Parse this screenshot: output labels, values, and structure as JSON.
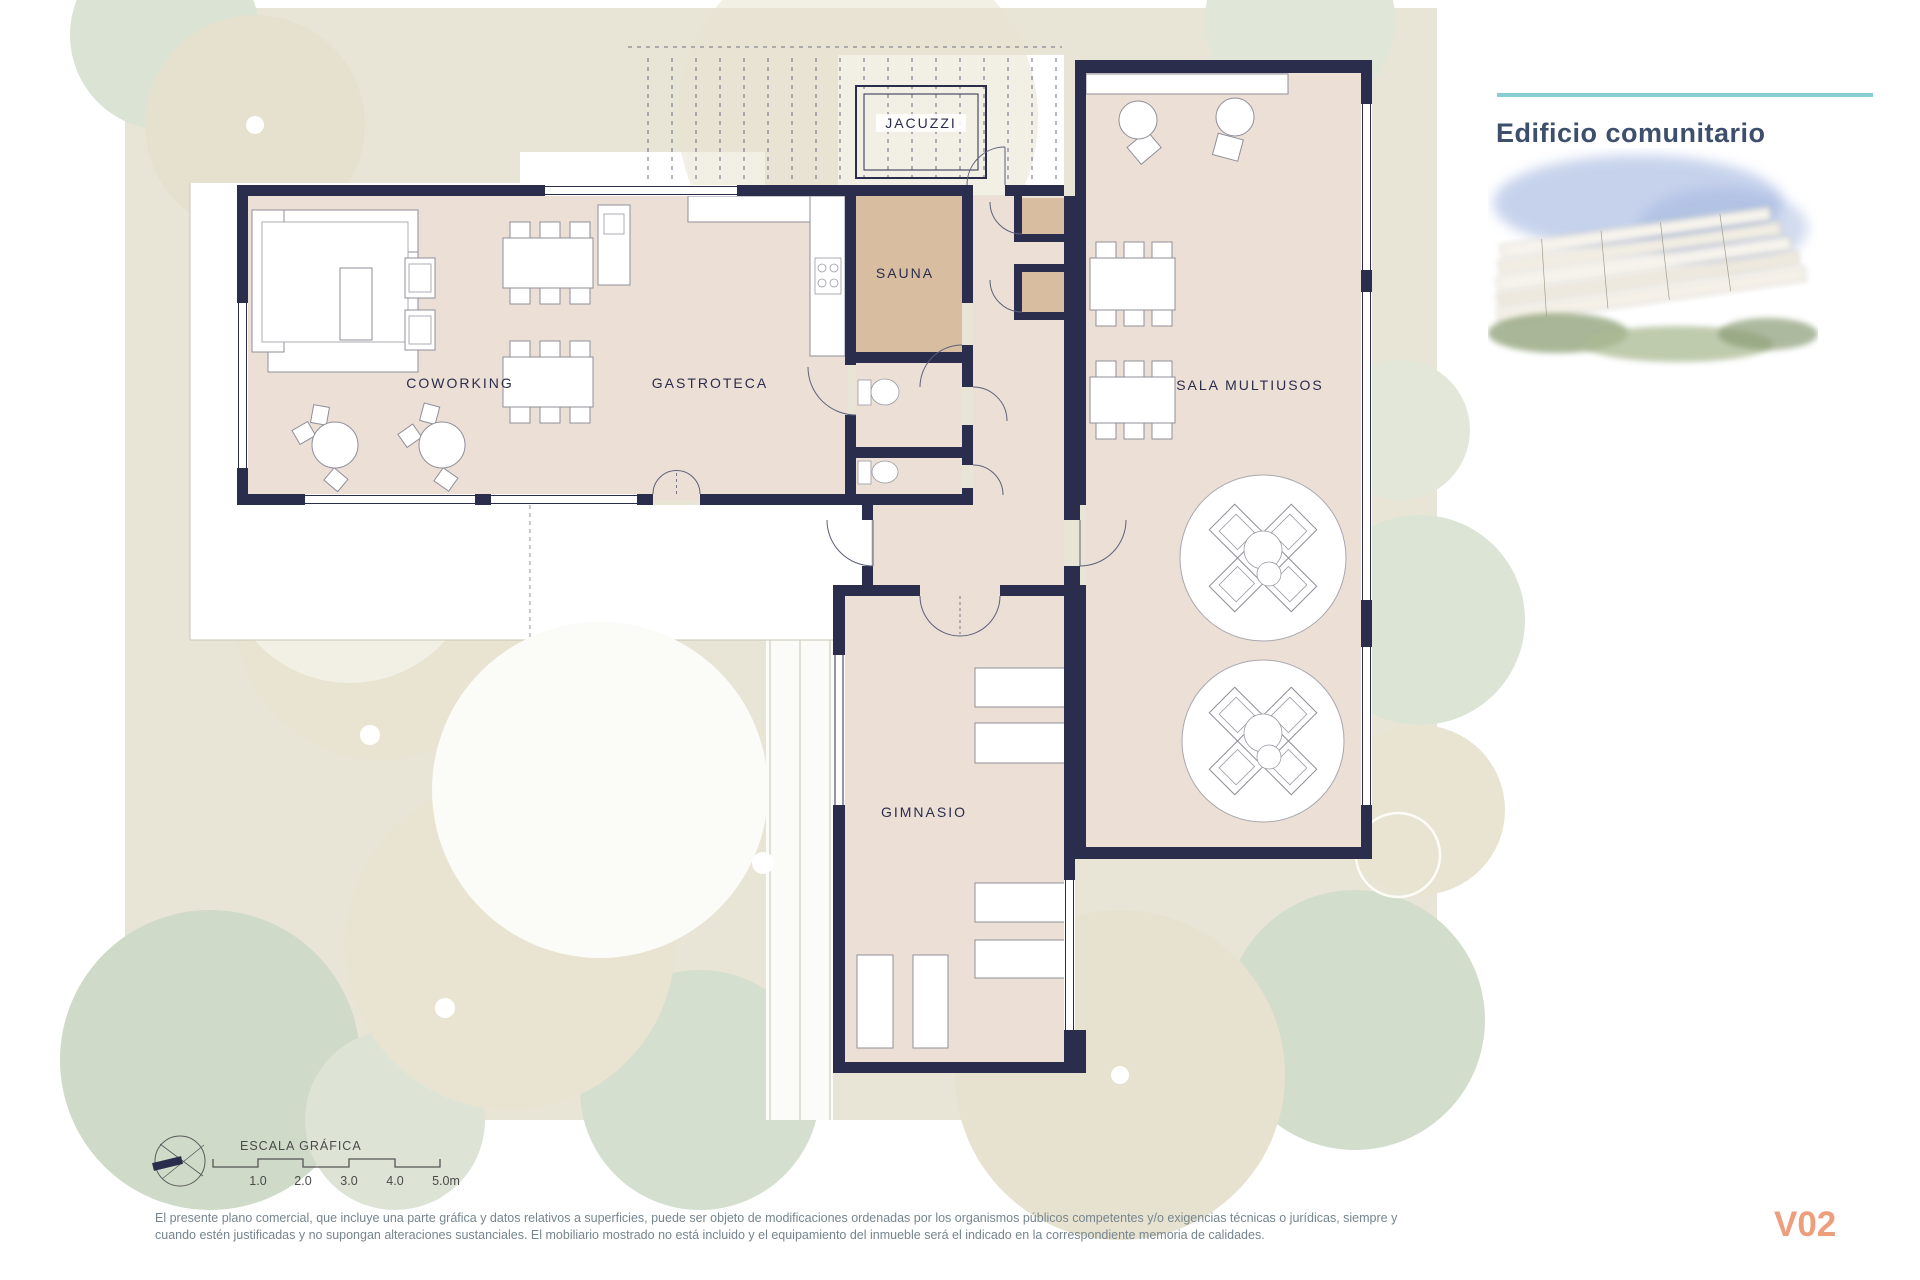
{
  "panel": {
    "title": "Edificio comunitario"
  },
  "version_label": "V02",
  "rooms": {
    "jacuzzi": "JACUZZI",
    "sauna": "SAUNA",
    "coworking": "COWORKING",
    "gastroteca": "GASTROTECA",
    "sala_multiusos": "SALA MULTIUSOS",
    "gimnasio": "GIMNASIO"
  },
  "scale_bar": {
    "title": "ESCALA GRÁFICA",
    "ticks": [
      "1.0",
      "2.0",
      "3.0",
      "4.0",
      "5.0m"
    ]
  },
  "disclaimer": {
    "line1": "El presente plano comercial, que incluye una parte gráfica y datos relativos a superficies, puede ser objeto de modificaciones ordenadas por los organismos públicos competentes y/o exigencias técnicas o jurídicas, siempre y",
    "line2": "cuando estén justificadas y no supongan alteraciones sustanciales. El mobiliario mostrado no está incluido y el equipamiento del inmueble será el indicado en la correspondiente memoria de calidades."
  },
  "colors": {
    "wall": "#2a2d4b",
    "floor": "#ecdfd6",
    "sauna_floor": "#d9bda1",
    "landscape": "#e8e5d6",
    "accent_teal": "#86ced2",
    "title_text": "#3d4f6d",
    "version_text": "#ec9e7d"
  }
}
